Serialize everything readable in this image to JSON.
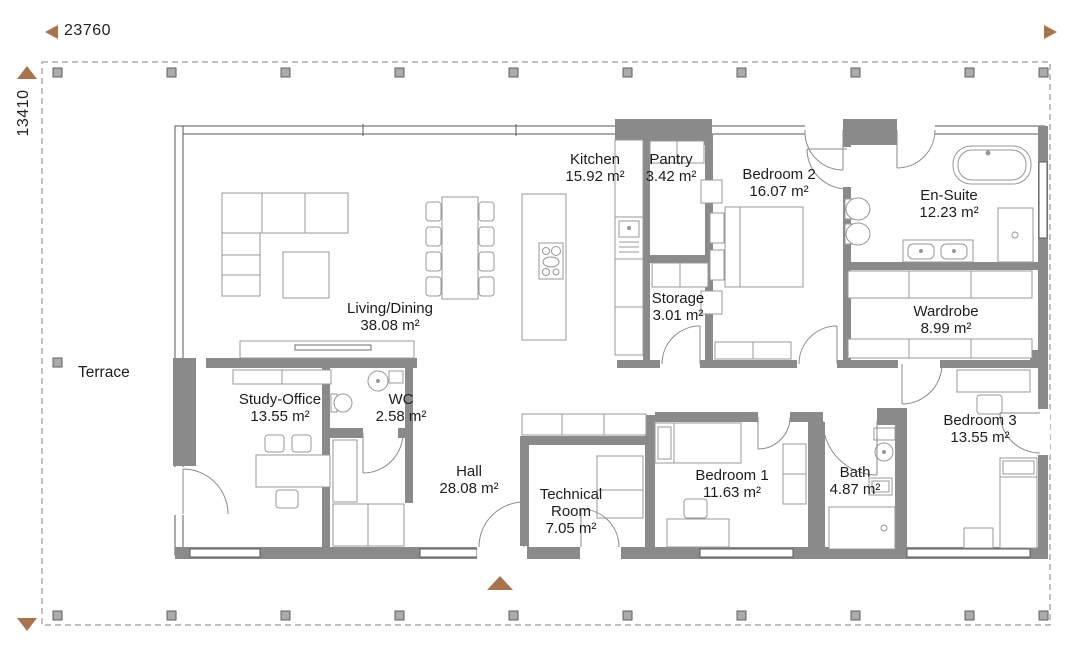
{
  "dimensions": {
    "width": "23760",
    "height": "13410"
  },
  "outdoor": {
    "terrace_label": "Terrace"
  },
  "rooms": [
    {
      "name": "Kitchen",
      "area": "15.92 m²"
    },
    {
      "name": "Pantry",
      "area": "3.42 m²"
    },
    {
      "name": "Bedroom 2",
      "area": "16.07 m²"
    },
    {
      "name": "En-Suite",
      "area": "12.23 m²"
    },
    {
      "name": "Living/Dining",
      "area": "38.08 m²"
    },
    {
      "name": "Storage",
      "area": "3.01 m²"
    },
    {
      "name": "Wardrobe",
      "area": "8.99 m²"
    },
    {
      "name": "Study-Office",
      "area": "13.55 m²"
    },
    {
      "name": "WC",
      "area": "2.58 m²"
    },
    {
      "name": "Hall",
      "area": "28.08 m²"
    },
    {
      "name": "Technical Room",
      "area": "7.05 m²"
    },
    {
      "name": "Bedroom 1",
      "area": "11.63 m²"
    },
    {
      "name": "Bath",
      "area": "4.87 m²"
    },
    {
      "name": "Bedroom 3",
      "area": "13.55 m²"
    }
  ],
  "colors": {
    "wall_gray": "#8a8a8a",
    "accent_brown": "#a87450",
    "text": "#1d1d1d",
    "boundary_dash": "#9a9a9a"
  }
}
